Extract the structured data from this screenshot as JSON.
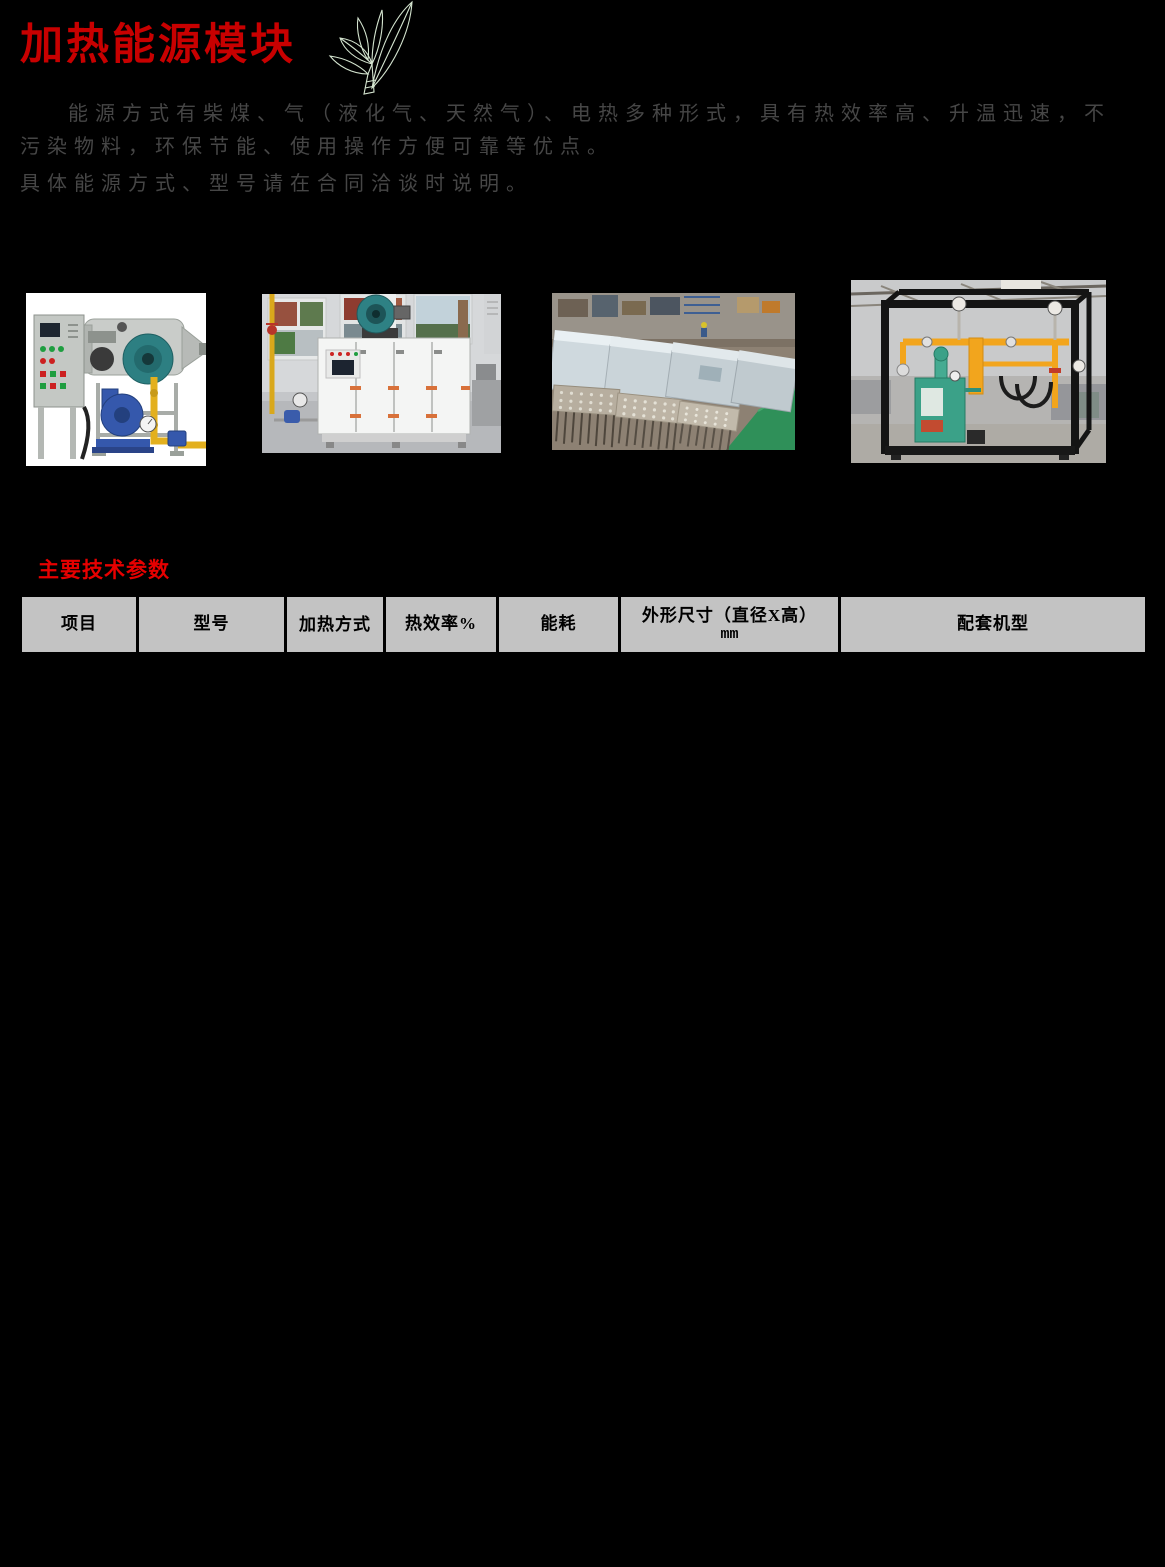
{
  "page": {
    "background": "#000000",
    "accent_red": "#c80000",
    "section_red": "#e60000"
  },
  "header": {
    "title": "加热能源模块",
    "leaf_icon": "tea-leaf-sketch-icon"
  },
  "intro": {
    "line1": "能源方式有柴煤、气（液化气、天然气）、电热多种形式，具有热效率高、升温迅速，不",
    "line2": "污染物料，环保节能、使用操作方便可靠等优点。",
    "line3": "具体能源方式、型号请在合同洽谈时说明。"
  },
  "photos": [
    {
      "name": "diesel-coal-hot-air-furnace-photo"
    },
    {
      "name": "gas-heating-oven-showroom-photo"
    },
    {
      "name": "electric-heating-units-workshop-photo"
    },
    {
      "name": "gas-manifold-skid-photo"
    }
  ],
  "specs": {
    "section_title": "主要技术参数",
    "table": {
      "header_bg": "#c3c3c3",
      "columns": [
        {
          "label": "项目"
        },
        {
          "label": "型号"
        },
        {
          "label": "加热方式"
        },
        {
          "label": "热效率%"
        },
        {
          "label": "能耗"
        },
        {
          "label": "外形尺寸（直径X高）",
          "sub": "mm"
        },
        {
          "label": "配套机型"
        }
      ]
    }
  }
}
